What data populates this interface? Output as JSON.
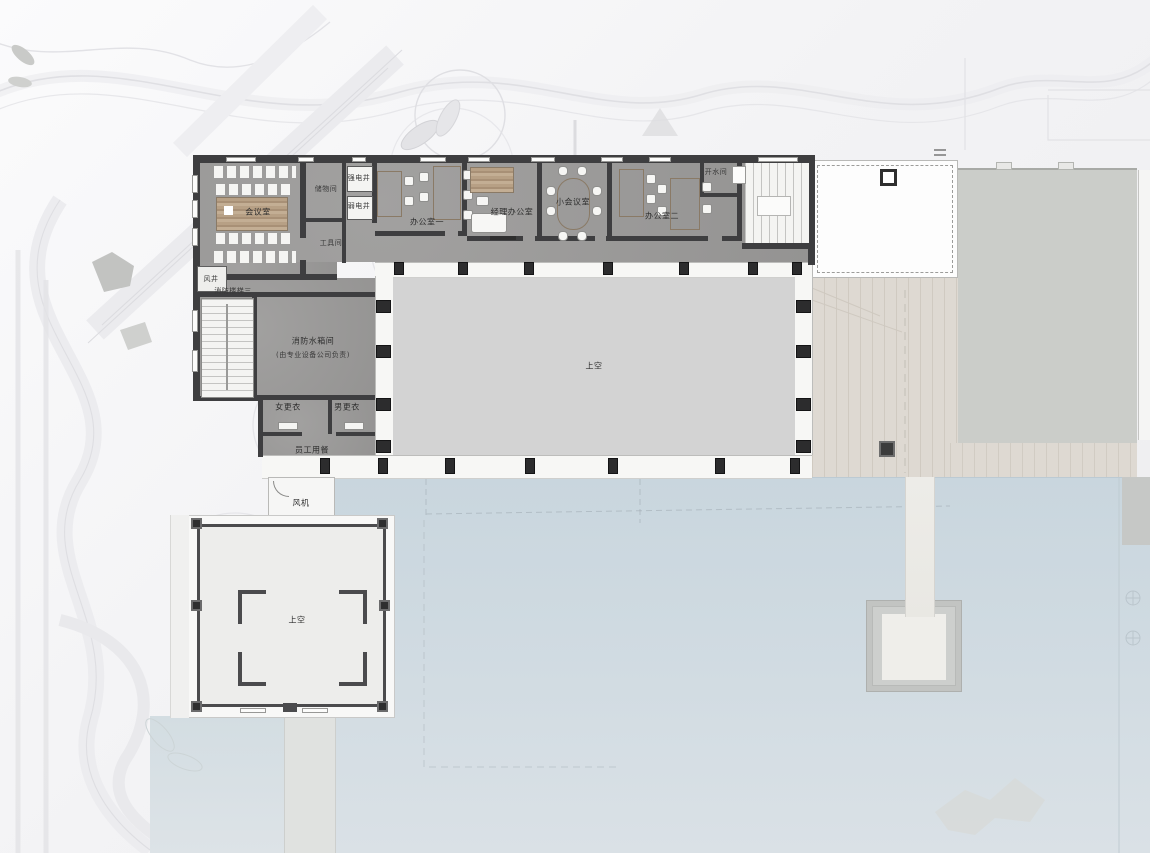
{
  "plan": {
    "kind": "architectural floor plan (upper level, office wing over lakeside pavilion)",
    "language": "zh-CN"
  },
  "labels": [
    {
      "id": "meeting-room",
      "text": "会议室"
    },
    {
      "id": "storage-room",
      "text": "储物间"
    },
    {
      "id": "strong-elec-shaft",
      "text": "强电井"
    },
    {
      "id": "weak-elec-shaft",
      "text": "弱电井"
    },
    {
      "id": "tool-room",
      "text": "工具间"
    },
    {
      "id": "office-1",
      "text": "办公室一"
    },
    {
      "id": "manager-office",
      "text": "经理办公室"
    },
    {
      "id": "small-meeting-room",
      "text": "小会议室"
    },
    {
      "id": "office-2",
      "text": "办公室二"
    },
    {
      "id": "hot-water-room",
      "text": "开水间"
    },
    {
      "id": "wind-shaft",
      "text": "风井"
    },
    {
      "id": "fire-stair-3",
      "text": "消防楼梯三"
    },
    {
      "id": "fire-water-tank",
      "text": "消防水箱间"
    },
    {
      "id": "fire-water-tank-note",
      "text": "(由专业设备公司负责)"
    },
    {
      "id": "women-changing",
      "text": "女更衣"
    },
    {
      "id": "men-changing",
      "text": "男更衣"
    },
    {
      "id": "staff-dining",
      "text": "员工用餐"
    },
    {
      "id": "void-over-hall",
      "text": "上空"
    },
    {
      "id": "fan-room",
      "text": "风机"
    },
    {
      "id": "void-over-pavilion",
      "text": "上空"
    }
  ],
  "colors": {
    "background": "#f1f1f2",
    "water": "#ccd8e0",
    "wall": "#3e3e40",
    "room_floor": "#9c9b9a",
    "void_floor": "#d3d3d3",
    "wood_furniture": "#b49c82",
    "terrace_deck": "#ded9d2",
    "adjacent_building": "#cbcdc9",
    "stair_white": "#f4f4f2",
    "landscape_line": "#e0e0e4"
  }
}
